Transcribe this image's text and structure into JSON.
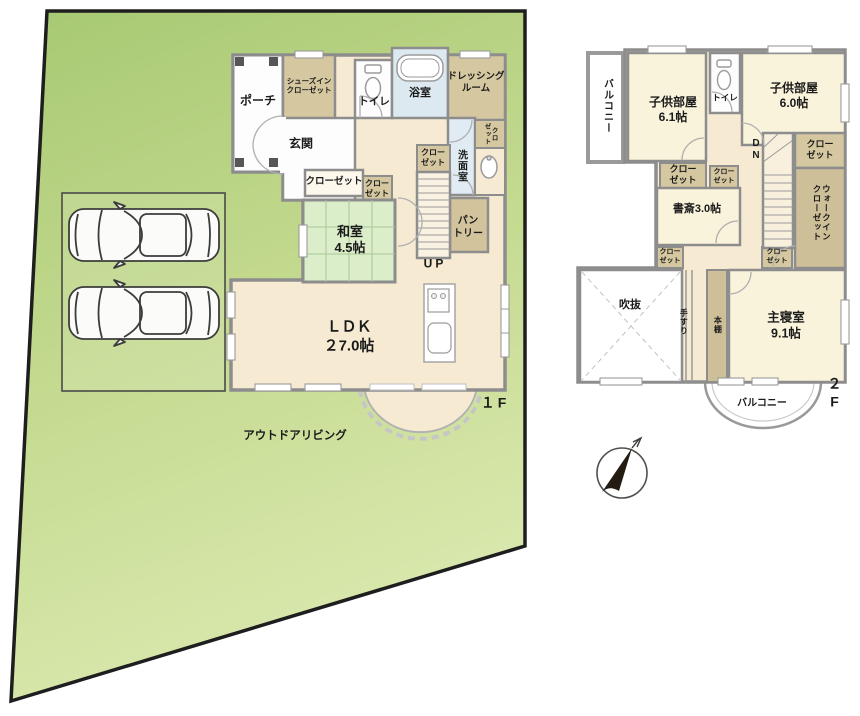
{
  "compass": {
    "icon": "north-arrow"
  },
  "floor1": {
    "label": "１F",
    "rooms": {
      "porch": "ポーチ",
      "shoes_in_closet": "シューズイン\nクローゼット",
      "toilet": "トイレ",
      "bath": "浴室",
      "dressing_room": "ドレッシング\nルーム",
      "entrance": "玄関",
      "washroom": "洗面室",
      "closet_wash": "クロ\nゼット",
      "closet_stairs": "クロー\nゼット",
      "closet_hall": "クローゼット",
      "closet_hall_small": "クロー\nゼット",
      "washitsu": "和室\n4.5帖",
      "pantry": "パン\nトリー",
      "stairs_up": "UP",
      "ldk": "ＬＤＫ\n２7.0帖",
      "outdoor_living": "アウトドアリビング"
    }
  },
  "floor2": {
    "label": "２F",
    "rooms": {
      "balcony_left": "バルコニー",
      "kids_room_1": "子供部屋\n6.1帖",
      "toilet": "トイレ",
      "kids_room_2": "子供部屋\n6.0帖",
      "stairs_down": "DN",
      "closet_kids2": "クロー\nゼット",
      "closet_kids1": "クロー\nゼット",
      "closet_hall_small": "クロー\nゼット",
      "study": "書斎3.0帖",
      "walk_in_closet": "ウォークイン\nクローゼット",
      "closet_study": "クロー\nゼット",
      "closet_stairs": "クロー\nゼット",
      "void": "吹抜",
      "handrail": "手すり",
      "bookshelf": "本棚",
      "master_bedroom": "主寝室\n9.1帖",
      "balcony_bottom": "バルコニー"
    }
  },
  "colors": {
    "lawn": "#b9d487",
    "wall": "#8d8d8d",
    "floor_cream": "#f6ead2",
    "closet_tan": "#d5c7a0",
    "tatami_green": "#dcedca",
    "wet_blue": "#dde9f1",
    "plot_border": "#1e1e1e"
  }
}
